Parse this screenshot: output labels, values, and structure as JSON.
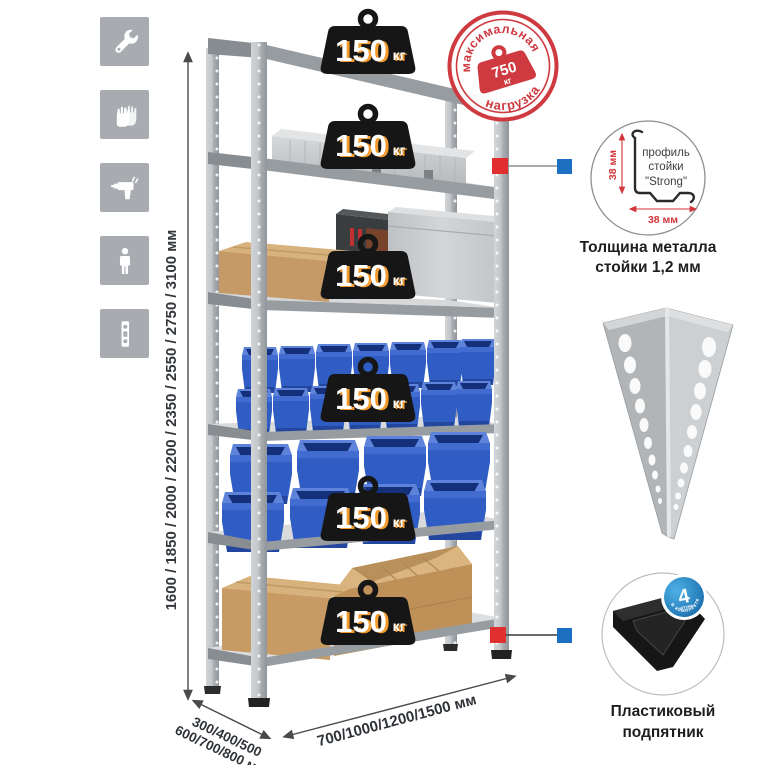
{
  "page": {
    "background": "#ffffff"
  },
  "colors": {
    "accent_red": "#cf3a41",
    "connector_red": "#e12f2f",
    "connector_blue": "#1d6fc2",
    "bin_blue": "#2f5dc4",
    "badge_black": "#161616",
    "badge_orange": "#f39c2d",
    "metal_gray": "#c7cacc",
    "tile_gray": "#a8acb1"
  },
  "left_icons": {
    "items": [
      {
        "name": "wrench"
      },
      {
        "name": "gloves"
      },
      {
        "name": "drill"
      },
      {
        "name": "person-height"
      },
      {
        "name": "perforated-profile"
      }
    ]
  },
  "dimensions": {
    "height": "1600 / 1850 / 2000 / 2200 / 2350 / 2550 / 2750 / 3100 мм",
    "depth_line1": "300/400/500",
    "depth_line2": "600/700/800 мм",
    "width": "700/1000/1200/1500 мм"
  },
  "shelf_badges": [
    {
      "value": "150",
      "unit": "кг"
    },
    {
      "value": "150",
      "unit": "кг"
    },
    {
      "value": "150",
      "unit": "кг"
    },
    {
      "value": "150",
      "unit": "кг"
    },
    {
      "value": "150",
      "unit": "кг"
    },
    {
      "value": "150",
      "unit": "кг"
    }
  ],
  "max_load_stamp": {
    "arc_top": "максимальная",
    "arc_bottom": "нагрузка",
    "value": "750",
    "unit": "кг"
  },
  "profile_detail": {
    "label_line1": "профиль",
    "label_line2": "стойки",
    "label_line3": "\"Strong\"",
    "dim_vertical": "38 мм",
    "dim_horizontal": "38 мм",
    "caption_line1": "Толщина металла",
    "caption_line2": "стойки 1,2 мм"
  },
  "foot_detail": {
    "badge_value": "4",
    "badge_word": "штуки",
    "badge_arc": "в комплекте",
    "caption_line1": "Пластиковый",
    "caption_line2": "подпятник"
  }
}
